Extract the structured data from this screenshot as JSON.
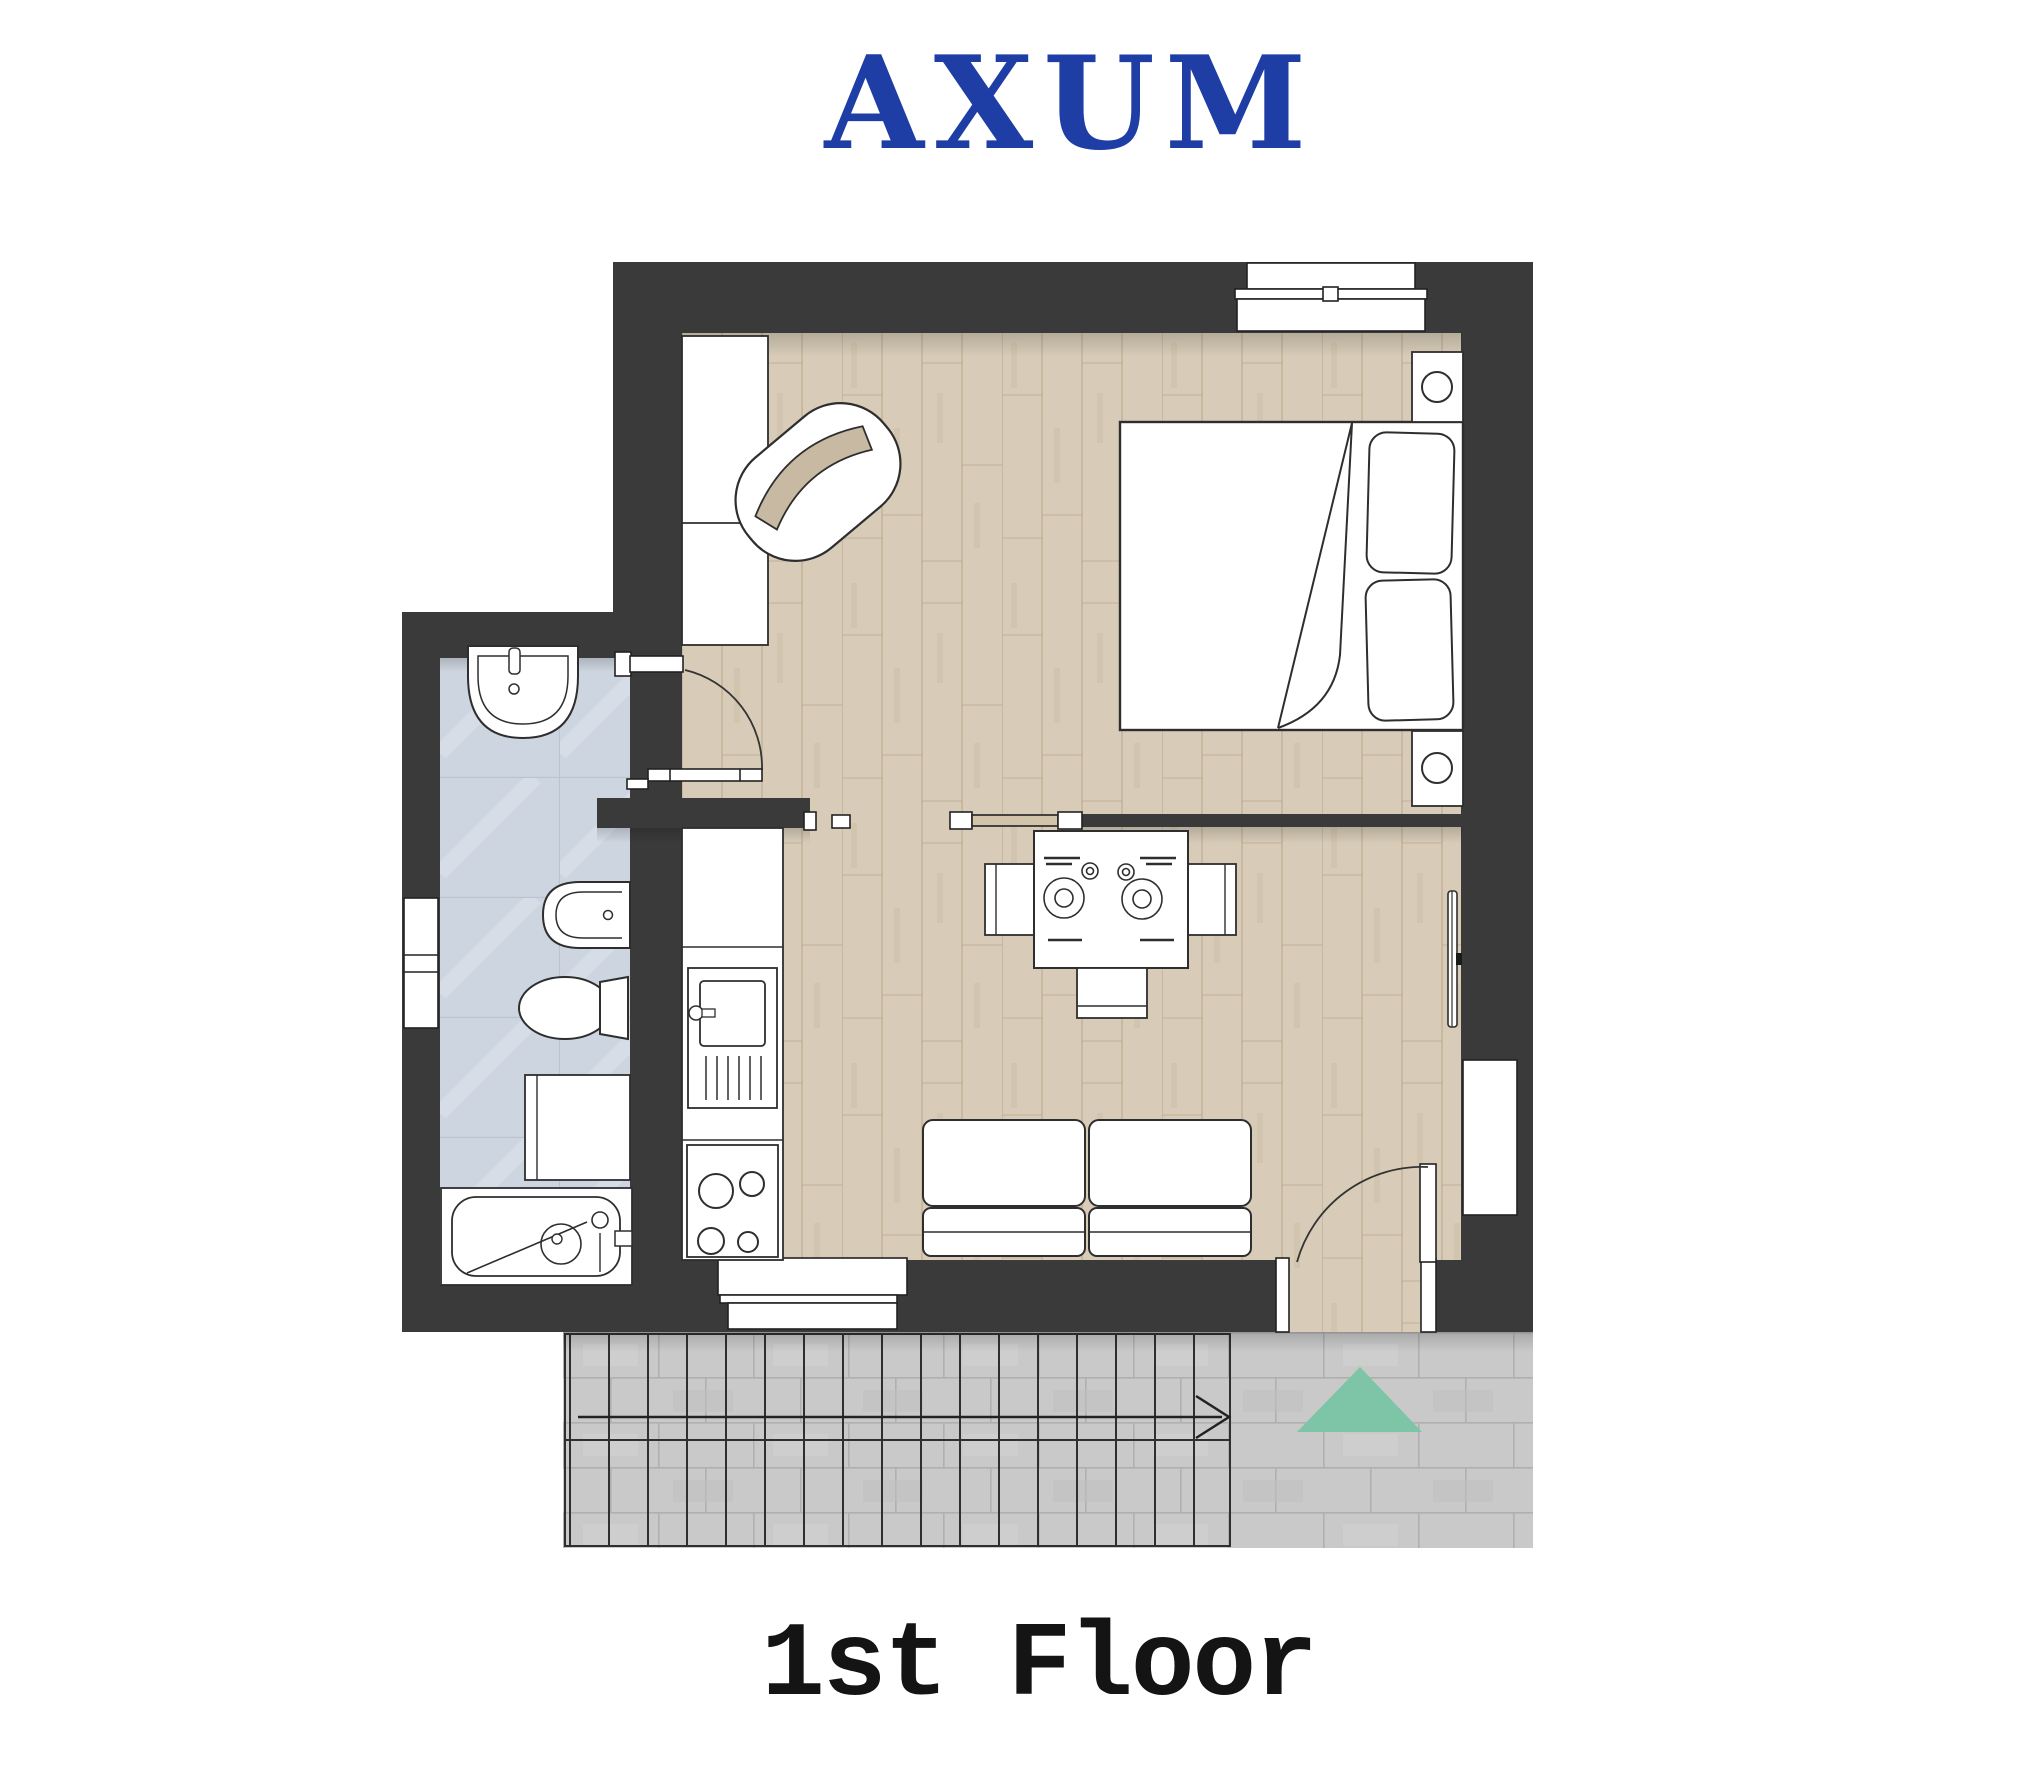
{
  "header": {
    "title": "AXUM",
    "title_color": "#1e3da5"
  },
  "footer": {
    "floor_label": "1st Floor",
    "text_color": "#141414"
  },
  "palette": {
    "wall": "#3a3a3a",
    "wood_floor": "#d8ccb8",
    "bathroom_floor": "#cdd5e0",
    "patio_tile": "#c9c9c9",
    "marker_green": "#7dc5a6",
    "furniture": "#ffffff",
    "outline": "#2e2e2e",
    "sliding_panel": "#d2c3ab"
  }
}
